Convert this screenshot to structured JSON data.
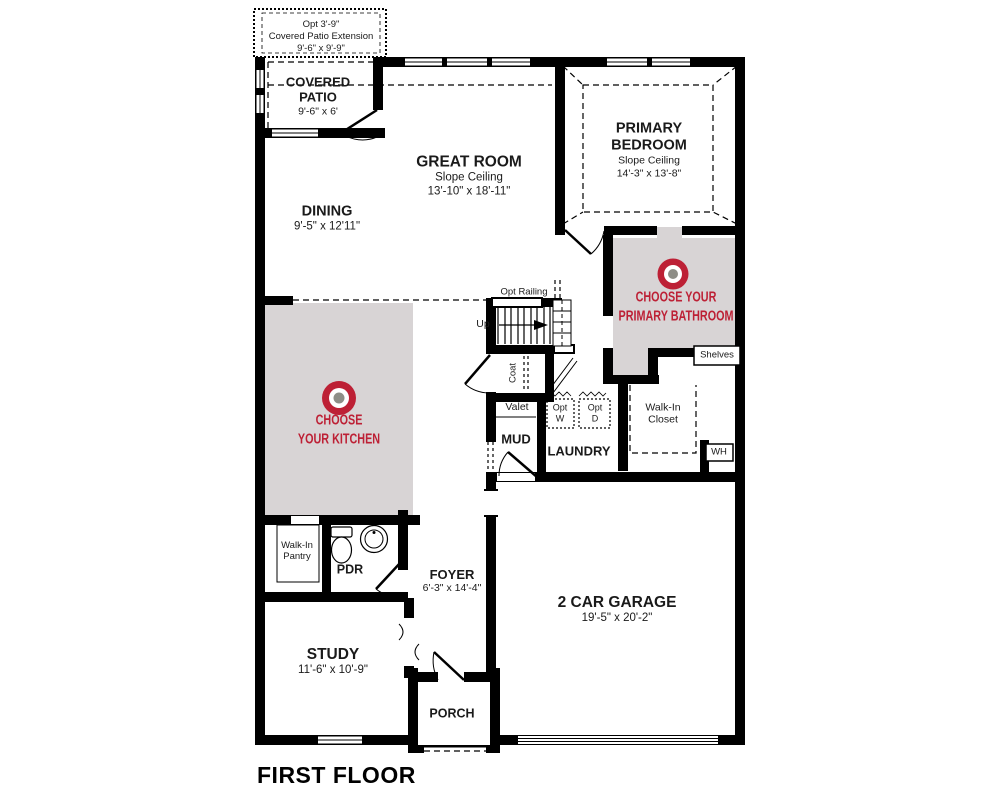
{
  "title": "FIRST FLOOR",
  "colors": {
    "accent_red": "#BD2035",
    "room_highlight_gray": "#D8D4D5",
    "icon_center_gray": "#8E8E87",
    "wall_black": "#000000"
  },
  "labels": {
    "opt_ext_1": "Opt 3'-9\"",
    "opt_ext_2": "Covered Patio Extension",
    "opt_ext_3": "9'-6\" x 9'-9\"",
    "covered_patio_name": "COVERED PATIO",
    "covered_patio_dims": "9'-6\" x 6'",
    "great_room_name": "GREAT ROOM",
    "great_room_note": "Slope Ceiling",
    "great_room_dims": "13'-10\" x 18'-11\"",
    "dining_name": "DINING",
    "dining_dims": "9'-5\" x 12'11\"",
    "primary_bedroom_name": "PRIMARY BEDROOM",
    "primary_bedroom_note": "Slope Ceiling",
    "primary_bedroom_dims": "14'-3\" x 13'-8\"",
    "bathroom_cta_1": "CHOOSE YOUR",
    "bathroom_cta_2": "PRIMARY BATHROOM",
    "kitchen_cta_1": "CHOOSE",
    "kitchen_cta_2": "YOUR KITCHEN",
    "opt_railing": "Opt Railing",
    "up": "Up",
    "coat": "Coat",
    "valet": "Valet",
    "mud": "MUD",
    "laundry": "LAUNDRY",
    "opt_w_1": "Opt",
    "opt_w_2": "W",
    "opt_d_1": "Opt",
    "opt_d_2": "D",
    "shelves": "Shelves",
    "walk_in_closet_1": "Walk-In",
    "walk_in_closet_2": "Closet",
    "wh": "WH",
    "pantry_1": "Walk-In",
    "pantry_2": "Pantry",
    "pdr": "PDR",
    "foyer_name": "FOYER",
    "foyer_dims": "6'-3\" x 14'-4\"",
    "study_name": "STUDY",
    "study_dims": "11'-6\" x 10'-9\"",
    "garage_name": "2 CAR GARAGE",
    "garage_dims": "19'-5\" x 20'-2\"",
    "porch_name": "PORCH"
  }
}
